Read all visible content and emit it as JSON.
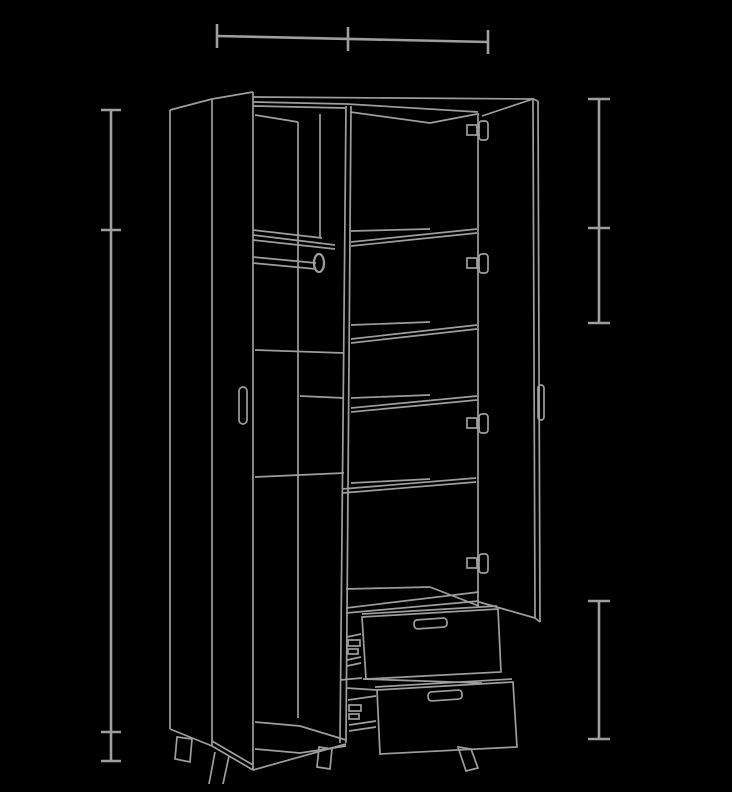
{
  "canvas": {
    "width": 732,
    "height": 792,
    "background_color": "#000000",
    "line_color": "#9e9e9e",
    "furniture_stroke_width": 1.7,
    "dimension_stroke_width": 2.6
  },
  "drawing": {
    "subject": "two-door-wardrobe-with-shelves-rod-and-two-drawers",
    "groups": [
      {
        "name": "dimension-top-width",
        "w": 2.6,
        "els": [
          {
            "t": "l",
            "p": [
              217,
              36,
              488,
              42
            ]
          },
          {
            "t": "l",
            "p": [
              217,
              24,
              217,
              48
            ]
          },
          {
            "t": "l",
            "p": [
              348,
              27,
              348,
              51
            ]
          },
          {
            "t": "l",
            "p": [
              488,
              30,
              488,
              54
            ]
          }
        ]
      },
      {
        "name": "dimension-left-height",
        "w": 2.6,
        "els": [
          {
            "t": "l",
            "p": [
              111,
              110,
              111,
              761
            ]
          },
          {
            "t": "l",
            "p": [
              101,
              110,
              121,
              110
            ]
          },
          {
            "t": "l",
            "p": [
              101,
              230,
              121,
              230
            ]
          },
          {
            "t": "l",
            "p": [
              101,
              732,
              121,
              732
            ]
          },
          {
            "t": "l",
            "p": [
              101,
              761,
              121,
              761
            ]
          }
        ]
      },
      {
        "name": "dimension-right-upper",
        "w": 2.6,
        "els": [
          {
            "t": "l",
            "p": [
              599,
              99,
              599,
              323
            ]
          },
          {
            "t": "l",
            "p": [
              588,
              99,
              610,
              99
            ]
          },
          {
            "t": "l",
            "p": [
              588,
              228,
              610,
              228
            ]
          },
          {
            "t": "l",
            "p": [
              588,
              323,
              610,
              323
            ]
          }
        ]
      },
      {
        "name": "dimension-right-lower",
        "w": 2.6,
        "els": [
          {
            "t": "l",
            "p": [
              599,
              601,
              599,
              739
            ]
          },
          {
            "t": "l",
            "p": [
              588,
              601,
              610,
              601
            ]
          },
          {
            "t": "l",
            "p": [
              588,
              739,
              610,
              739
            ]
          }
        ]
      },
      {
        "name": "carcass",
        "w": 1.7,
        "els": [
          {
            "t": "l",
            "p": [
              170,
              110,
              170,
              729
            ]
          },
          {
            "t": "l",
            "p": [
              170,
              110,
              212,
              99
            ]
          },
          {
            "t": "l",
            "p": [
              170,
              729,
              212,
              746
            ]
          },
          {
            "t": "l",
            "p": [
              253,
              97,
              534,
              99
            ]
          },
          {
            "t": "pl",
            "p": [
              253,
              102,
              347,
              104,
              478,
              112
            ]
          },
          {
            "t": "l",
            "p": [
              253,
              106,
              345,
              108
            ]
          },
          {
            "t": "l",
            "p": [
              255,
              115,
              298,
              122
            ]
          },
          {
            "t": "l",
            "p": [
              350,
              112,
              430,
              123
            ]
          },
          {
            "t": "l",
            "p": [
              430,
              123,
              477,
              114
            ]
          },
          {
            "t": "l",
            "p": [
              298,
              122,
              298,
              718
            ]
          },
          {
            "t": "l",
            "p": [
              320,
              114,
              320,
              238
            ]
          },
          {
            "t": "l",
            "p": [
              346,
              106,
              340,
              743
            ]
          },
          {
            "t": "l",
            "p": [
              351,
              106,
              346,
              743
            ]
          },
          {
            "t": "l",
            "p": [
              478,
              113,
              478,
              608
            ]
          },
          {
            "t": "pl",
            "p": [
              255,
              722,
              300,
              726,
              346,
              740
            ]
          },
          {
            "t": "pl",
            "p": [
              255,
              749,
              300,
              753,
              346,
              746
            ]
          },
          {
            "t": "l",
            "p": [
              253,
              770,
              346,
              744
            ]
          }
        ]
      },
      {
        "name": "left-door-ajar",
        "w": 1.7,
        "els": [
          {
            "t": "l",
            "p": [
              212,
              99,
              212,
              746
            ]
          },
          {
            "t": "l",
            "p": [
              212,
              99,
              253,
              92
            ]
          },
          {
            "t": "l",
            "p": [
              253,
              92,
              253,
              770
            ]
          },
          {
            "t": "l",
            "p": [
              212,
              746,
              253,
              770
            ]
          },
          {
            "t": "l",
            "p": [
              212,
              741,
              253,
              765
            ]
          },
          {
            "t": "r",
            "p": [
              239,
              387,
              8,
              37
            ],
            "rx": 4
          }
        ]
      },
      {
        "name": "left-compartment-rod-shelf",
        "w": 1.7,
        "els": [
          {
            "t": "l",
            "p": [
              253,
              230,
              322,
              238
            ]
          },
          {
            "t": "l",
            "p": [
              253,
              235,
              335,
              245
            ]
          },
          {
            "t": "l",
            "p": [
              253,
              240,
              335,
              249
            ]
          },
          {
            "t": "l",
            "p": [
              253,
              257,
              316,
              263
            ]
          },
          {
            "t": "l",
            "p": [
              253,
              263,
              316,
              269
            ]
          },
          {
            "t": "e",
            "p": [
              319,
              263,
              5,
              9
            ],
            "w": 2.2
          },
          {
            "t": "l",
            "p": [
              255,
              350,
              344,
              353
            ]
          },
          {
            "t": "l",
            "p": [
              300,
              396,
              344,
              398
            ]
          },
          {
            "t": "l",
            "p": [
              255,
              477,
              344,
              473
            ]
          }
        ]
      },
      {
        "name": "right-compartment-shelves",
        "w": 1.7,
        "els": [
          {
            "t": "l",
            "p": [
              351,
              231,
              430,
              229
            ]
          },
          {
            "t": "l",
            "p": [
              351,
              242,
              477,
              229
            ]
          },
          {
            "t": "l",
            "p": [
              351,
              246,
              477,
              233
            ]
          },
          {
            "t": "l",
            "p": [
              351,
              325,
              430,
              322
            ]
          },
          {
            "t": "l",
            "p": [
              351,
              339,
              477,
              325
            ]
          },
          {
            "t": "l",
            "p": [
              351,
              343,
              477,
              329
            ]
          },
          {
            "t": "l",
            "p": [
              351,
              398,
              430,
              395
            ]
          },
          {
            "t": "l",
            "p": [
              351,
              408,
              477,
              396
            ]
          },
          {
            "t": "l",
            "p": [
              351,
              412,
              477,
              400
            ]
          },
          {
            "t": "l",
            "p": [
              351,
              483,
              430,
              479
            ]
          },
          {
            "t": "l",
            "p": [
              342,
              489,
              476,
              478
            ]
          },
          {
            "t": "l",
            "p": [
              342,
              493,
              476,
              482
            ]
          },
          {
            "t": "l",
            "p": [
              346,
              589,
              430,
              587
            ]
          },
          {
            "t": "l",
            "p": [
              430,
              587,
              479,
              606
            ]
          },
          {
            "t": "l",
            "p": [
              346,
              608,
              479,
              592
            ]
          },
          {
            "t": "l",
            "p": [
              346,
              613,
              479,
              601
            ]
          }
        ]
      },
      {
        "name": "right-door-open",
        "w": 1.7,
        "els": [
          {
            "t": "l",
            "p": [
              482,
              116,
              533,
              99
            ]
          },
          {
            "t": "l",
            "p": [
              533,
              99,
              535,
              618
            ]
          },
          {
            "t": "l",
            "p": [
              538,
              101,
              540,
              622
            ]
          },
          {
            "t": "l",
            "p": [
              533,
              99,
              538,
              101
            ]
          },
          {
            "t": "l",
            "p": [
              479,
              602,
              535,
              618
            ]
          },
          {
            "t": "l",
            "p": [
              535,
              618,
              540,
              622
            ]
          },
          {
            "t": "r",
            "p": [
              538,
              385,
              6,
              35
            ],
            "rx": 3
          }
        ]
      },
      {
        "name": "hinge-1",
        "w": 1.7,
        "els": [
          {
            "t": "r",
            "p": [
              467,
              125,
              10,
              10
            ]
          },
          {
            "t": "r",
            "p": [
              479,
              121,
              9,
              19
            ],
            "rx": 3
          },
          {
            "t": "l",
            "p": [
              476,
              127,
              480,
              127
            ]
          },
          {
            "t": "l",
            "p": [
              476,
              135,
              480,
              135
            ]
          }
        ]
      },
      {
        "name": "hinge-2",
        "w": 1.7,
        "els": [
          {
            "t": "r",
            "p": [
              467,
              258,
              10,
              10
            ]
          },
          {
            "t": "r",
            "p": [
              479,
              254,
              9,
              19
            ],
            "rx": 3
          },
          {
            "t": "l",
            "p": [
              476,
              260,
              480,
              260
            ]
          },
          {
            "t": "l",
            "p": [
              476,
              268,
              480,
              268
            ]
          }
        ]
      },
      {
        "name": "hinge-3",
        "w": 1.7,
        "els": [
          {
            "t": "r",
            "p": [
              467,
              418,
              10,
              10
            ]
          },
          {
            "t": "r",
            "p": [
              479,
              414,
              9,
              19
            ],
            "rx": 3
          },
          {
            "t": "l",
            "p": [
              476,
              420,
              480,
              420
            ]
          },
          {
            "t": "l",
            "p": [
              476,
              428,
              480,
              428
            ]
          }
        ]
      },
      {
        "name": "hinge-4",
        "w": 1.7,
        "els": [
          {
            "t": "r",
            "p": [
              467,
              558,
              10,
              10
            ]
          },
          {
            "t": "r",
            "p": [
              479,
              554,
              9,
              19
            ],
            "rx": 3
          },
          {
            "t": "l",
            "p": [
              476,
              560,
              480,
              560
            ]
          },
          {
            "t": "l",
            "p": [
              476,
              568,
              480,
              568
            ]
          }
        ]
      },
      {
        "name": "drawer-upper",
        "w": 1.7,
        "els": [
          {
            "t": "pg",
            "p": [
              362,
              617,
              498,
              609,
              501,
              672,
              366,
              679
            ]
          },
          {
            "t": "l",
            "p": [
              362,
              614,
              497,
              606
            ]
          },
          {
            "t": "r",
            "p": [
              414,
              619,
              33,
              9
            ],
            "rx": 3.5,
            "tr": "rotate(-4 430 623)"
          },
          {
            "t": "l",
            "p": [
              347,
              637,
              361,
              634
            ]
          },
          {
            "t": "r",
            "p": [
              348,
              640,
              12,
              6
            ]
          },
          {
            "t": "r",
            "p": [
              348,
              649,
              10,
              5
            ]
          },
          {
            "t": "l",
            "p": [
              347,
              660,
              361,
              657
            ]
          },
          {
            "t": "l",
            "p": [
              347,
              666,
              361,
              663
            ]
          },
          {
            "t": "l",
            "p": [
              340,
              680,
              362,
              678
            ]
          },
          {
            "t": "l",
            "p": [
              363,
              679,
              482,
              683
            ]
          }
        ]
      },
      {
        "name": "drawer-lower",
        "w": 1.7,
        "els": [
          {
            "t": "pg",
            "p": [
              377,
              690,
              513,
              682,
              517,
              747,
              380,
              754
            ]
          },
          {
            "t": "l",
            "p": [
              375,
              687,
              512,
              679
            ]
          },
          {
            "t": "r",
            "p": [
              428,
              691,
              34,
              9
            ],
            "rx": 3.5,
            "tr": "rotate(-4 445 695)"
          },
          {
            "t": "l",
            "p": [
              346,
              688,
              377,
              690
            ]
          },
          {
            "t": "l",
            "p": [
              348,
              700,
              376,
              696
            ]
          },
          {
            "t": "r",
            "p": [
              349,
              705,
              12,
              6
            ]
          },
          {
            "t": "r",
            "p": [
              349,
              714,
              10,
              5
            ]
          },
          {
            "t": "l",
            "p": [
              349,
              725,
              376,
              721
            ]
          },
          {
            "t": "l",
            "p": [
              349,
              731,
              376,
              727
            ]
          }
        ]
      },
      {
        "name": "legs",
        "w": 1.7,
        "els": [
          {
            "t": "pg",
            "p": [
              177,
              737,
              192,
              739,
              190,
              762,
              175,
              759
            ]
          },
          {
            "t": "l",
            "p": [
              215,
              752,
              209,
              784
            ]
          },
          {
            "t": "l",
            "p": [
              229,
              756,
              223,
              784
            ]
          },
          {
            "t": "pg",
            "p": [
              319,
              747,
              332,
              749,
              330,
              769,
              317,
              767
            ]
          },
          {
            "t": "pg",
            "p": [
              458,
              747,
              471,
              749,
              478,
              768,
              466,
              771
            ]
          }
        ]
      }
    ]
  }
}
